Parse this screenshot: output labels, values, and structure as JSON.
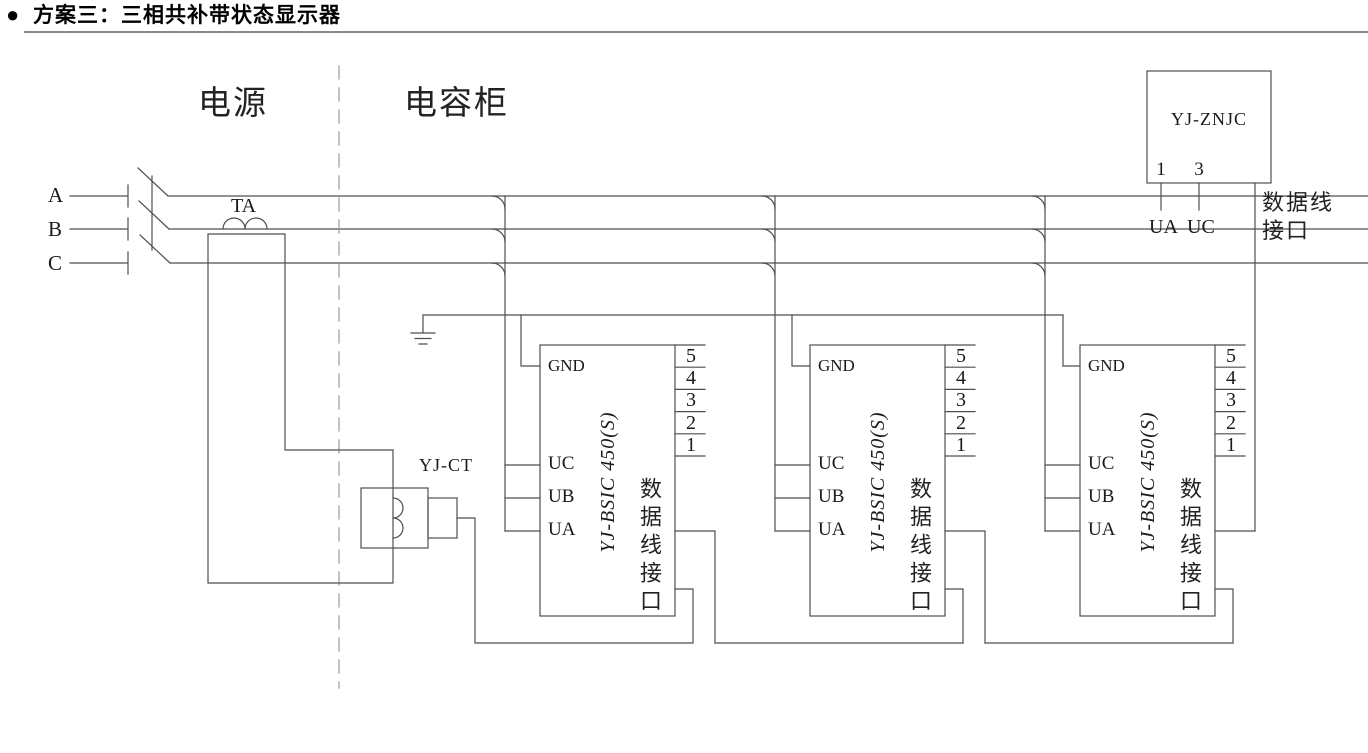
{
  "title": {
    "bullet": "●",
    "text": "方案三：三相共补带状态显示器"
  },
  "sections": {
    "power": "电源",
    "capacitor_cabinet": "电容柜"
  },
  "phases": {
    "a": "A",
    "b": "B",
    "c": "C"
  },
  "ta_label": "TA",
  "ct_label": "YJ-CT",
  "modules": [
    {
      "model": "YJ-BSIC 450(S)",
      "pin_gnd": "GND",
      "pin_uc": "UC",
      "pin_ub": "UB",
      "pin_ua": "UA",
      "pins_right": [
        "5",
        "4",
        "3",
        "2",
        "1"
      ],
      "interface_label": "数据线接口"
    },
    {
      "model": "YJ-BSIC 450(S)",
      "pin_gnd": "GND",
      "pin_uc": "UC",
      "pin_ub": "UB",
      "pin_ua": "UA",
      "pins_right": [
        "5",
        "4",
        "3",
        "2",
        "1"
      ],
      "interface_label": "数据线接口"
    },
    {
      "model": "YJ-BSIC 450(S)",
      "pin_gnd": "GND",
      "pin_uc": "UC",
      "pin_ub": "UB",
      "pin_ua": "UA",
      "pins_right": [
        "5",
        "4",
        "3",
        "2",
        "1"
      ],
      "interface_label": "数据线接口"
    }
  ],
  "display_unit": {
    "model": "YJ-ZNJC",
    "pin_1": "1",
    "pin_3": "3",
    "pin_1_label": "UA",
    "pin_3_label": "UC",
    "interface_line1": "数据线",
    "interface_line2": "接口"
  },
  "colors": {
    "wire": "#4f4f4f",
    "dashed": "#9a9a9a",
    "underline": "#8a8a8a",
    "text": "#1a1a1a"
  }
}
